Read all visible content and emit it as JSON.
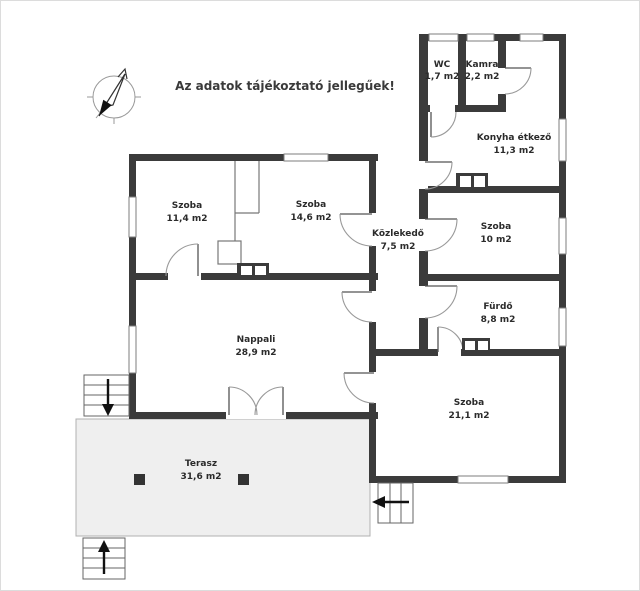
{
  "title": "Az adatok tájékoztató jellegűek!",
  "rooms": [
    {
      "name": "WC",
      "area": "1,7 m2"
    },
    {
      "name": "Kamra",
      "area": "2,2 m2"
    },
    {
      "name": "Konyha étkező",
      "area": "11,3 m2"
    },
    {
      "name": "Szoba",
      "area": "11,4 m2"
    },
    {
      "name": "Szoba",
      "area": "14,6 m2"
    },
    {
      "name": "Közlekedő",
      "area": "7,5 m2"
    },
    {
      "name": "Szoba",
      "area": "10 m2"
    },
    {
      "name": "Fürdő",
      "area": "8,8 m2"
    },
    {
      "name": "Nappali",
      "area": "28,9 m2"
    },
    {
      "name": "Szoba",
      "area": "21,1 m2"
    },
    {
      "name": "Terasz",
      "area": "31,6 m2"
    }
  ],
  "icons": {
    "compass": "north-compass-icon",
    "stairs_left_arrow": "arrow-down",
    "stairs_bottom_arrow": "arrow-up",
    "stairs_right_arrow": "arrow-left"
  },
  "colors": {
    "wall": "#3b3b3b",
    "terrace_fill": "#efefef",
    "text": "#2b2b2b",
    "thin_line": "#8a8a8a"
  }
}
